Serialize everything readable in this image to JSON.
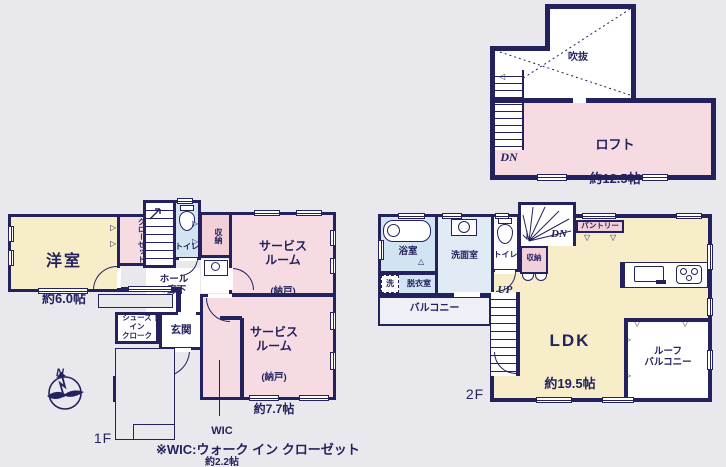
{
  "note": "※WIC:ウォーク イン クローゼット",
  "compass": {
    "north": "N"
  },
  "icons": {
    "fr": "▷",
    "fd": "▽",
    "sl": "△",
    "fl": "◁"
  },
  "floor1": {
    "label": "1F",
    "stairs_up": "UP",
    "rooms": {
      "yoshitsu": {
        "name": "洋室",
        "size": "約6.0帖"
      },
      "closet": {
        "name": "クローゼット"
      },
      "toilet": {
        "name": "トイレ"
      },
      "storage": {
        "name": "収納"
      },
      "service6": {
        "name": "サービス\nルーム",
        "annex": "(納戸)",
        "size": "約6.0帖"
      },
      "hall": {
        "name": "ホール\n+廊下"
      },
      "shoes": {
        "name": "シューズ\nイン\nクローク"
      },
      "genkan": {
        "name": "玄関"
      },
      "service77": {
        "name": "サービス\nルーム",
        "annex": "(納戸)",
        "size": "約7.7帖"
      },
      "wic": {
        "name": "WIC",
        "size": "約2.2帖"
      }
    }
  },
  "floor2": {
    "label": "2F",
    "stairs_up": "UP",
    "stairs_dn": "DN",
    "rooms": {
      "bath": {
        "name": "浴室"
      },
      "laundry": {
        "name": "洗"
      },
      "dressing": {
        "name": "脱衣室"
      },
      "washroom": {
        "name": "洗面室"
      },
      "toilet": {
        "name": "トイレ"
      },
      "storage": {
        "name": "収納"
      },
      "pantry": {
        "name": "パントリー"
      },
      "ldk": {
        "name": "LDK",
        "size": "約19.5帖"
      },
      "balcony": {
        "name": "バルコニー"
      },
      "roof_balcony": {
        "name": "ルーフ\nバルコニー"
      }
    }
  },
  "loft": {
    "stairs_dn": "DN",
    "void": {
      "name": "吹抜"
    },
    "rooms": {
      "loft": {
        "name": "ロフト",
        "size": "約12.5帖"
      }
    }
  }
}
